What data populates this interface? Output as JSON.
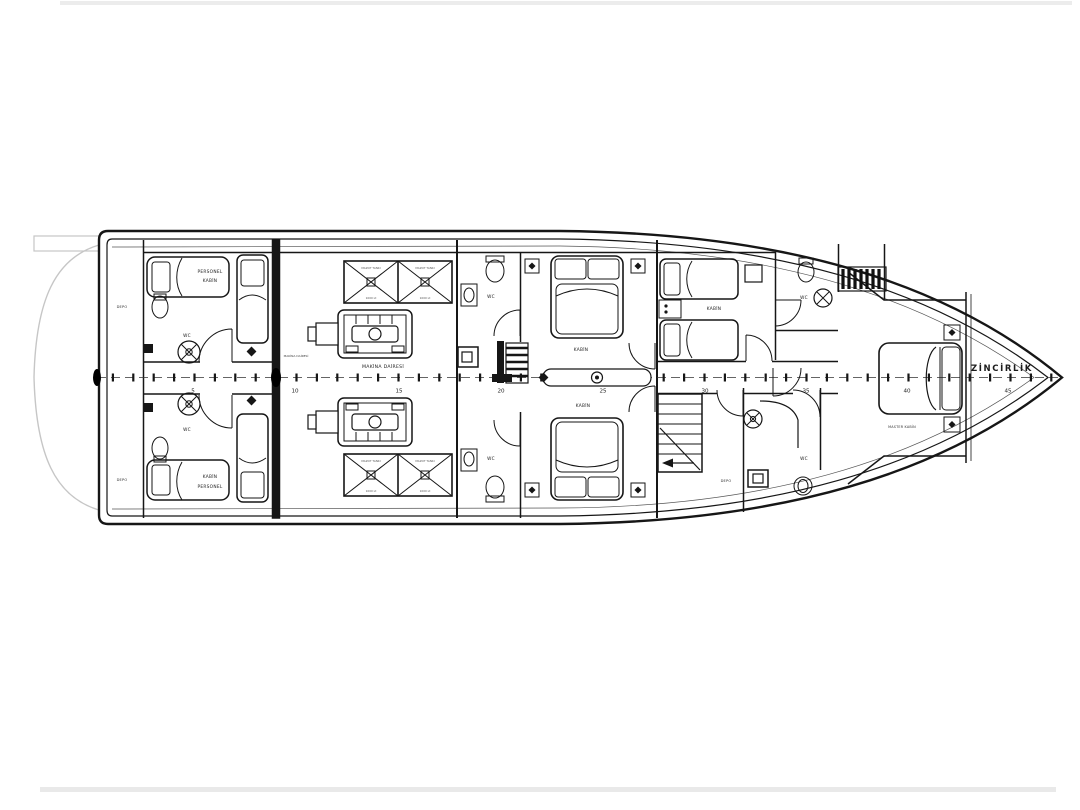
{
  "labels": {
    "zincirlik": "ZİNCİRLİK",
    "master_kabin": "MASTER KABİN",
    "makina_dairesi": "MAKİNA DAİRESİ",
    "kabin": "KABİN",
    "wc": "WC",
    "depo": "DEPO",
    "personel_kabin_l1": "PERSONEL",
    "personel_kabin_l2": "KABİN",
    "kabin_personel_l1": "KABİN",
    "kabin_personel_l2": "PERSONEL",
    "tank_top": "MAZOT TANKI",
    "tank_bottom": "1000 Lt"
  },
  "ruler": {
    "ticks": [
      "5",
      "10",
      "15",
      "20",
      "25",
      "30",
      "35",
      "40",
      "45"
    ]
  },
  "colors": {
    "line": "#161616",
    "faint": "#c6c6c6",
    "paper": "#ffffff"
  }
}
